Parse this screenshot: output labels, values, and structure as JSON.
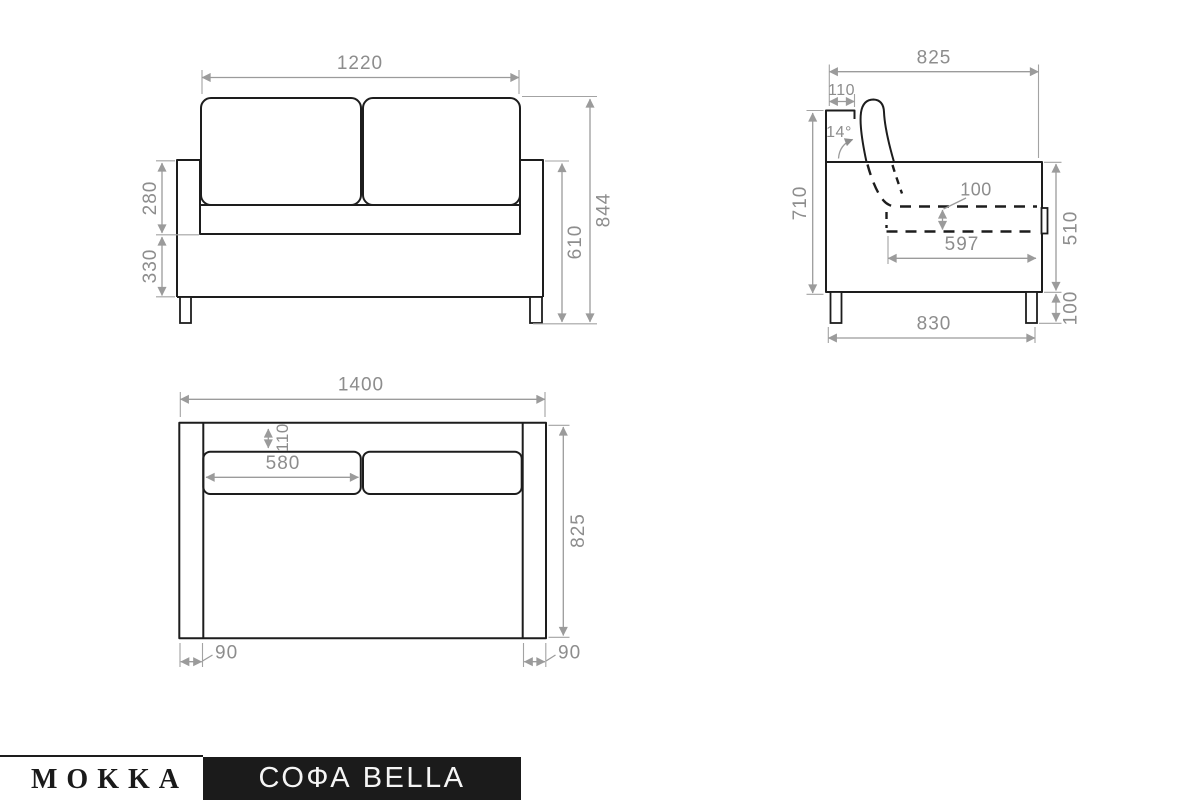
{
  "page": {
    "background": "#ffffff"
  },
  "colors": {
    "outline": "#1d1d1d",
    "dimension_line": "#9b9b9b",
    "dimension_text": "#8d8d8d",
    "footer_box_bg": "#1b1b1b",
    "footer_box_text": "#f5f5f5",
    "brand_text": "#1a1a1a"
  },
  "views": {
    "front": {
      "dims": {
        "seat_width": "1220",
        "backrest_above_arm": "280",
        "base_height": "330",
        "arm_height": "610",
        "total_height": "844"
      }
    },
    "side": {
      "dims": {
        "depth_top": "825",
        "backrest_top_depth": "110",
        "backrest_angle": "14°",
        "side_height": "710",
        "cushion_thickness": "100",
        "fold_out_length": "597",
        "frame_side_height": "510",
        "leg_height": "100",
        "depth_bottom": "830"
      }
    },
    "top": {
      "dims": {
        "total_width": "1400",
        "backrest_depth": "110",
        "seat_cushion_width": "580",
        "total_depth": "825",
        "left_arm_width": "90",
        "right_arm_width": "90"
      }
    }
  },
  "footer": {
    "brand": "MOKKA",
    "product": "СОФА BELLA"
  }
}
